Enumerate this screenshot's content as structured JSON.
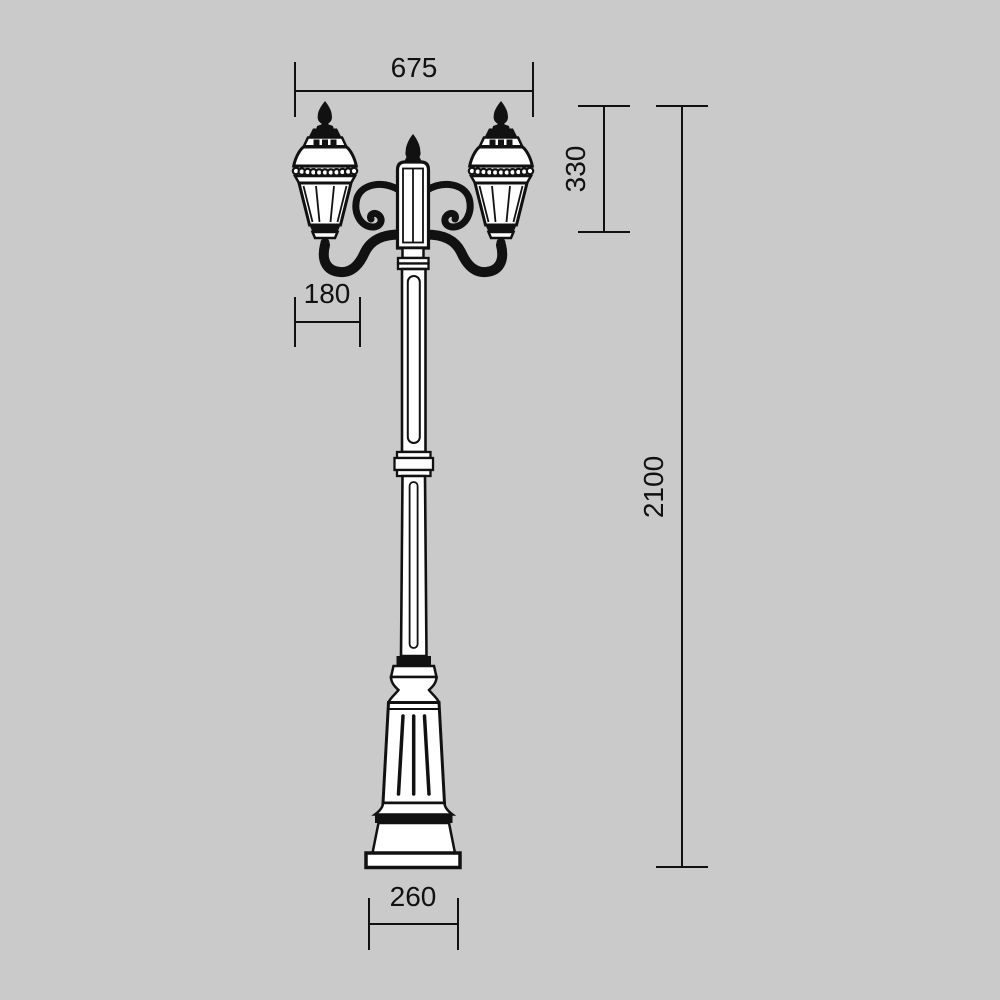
{
  "colors": {
    "background": "#cacaca",
    "ink": "#111111"
  },
  "figure": {
    "name": "two-head-street-lamp-dimension-drawing",
    "dimensions": {
      "overall_width": "675",
      "lantern_height": "330",
      "lantern_width": "180",
      "overall_height": "2100",
      "base_width": "260"
    }
  }
}
